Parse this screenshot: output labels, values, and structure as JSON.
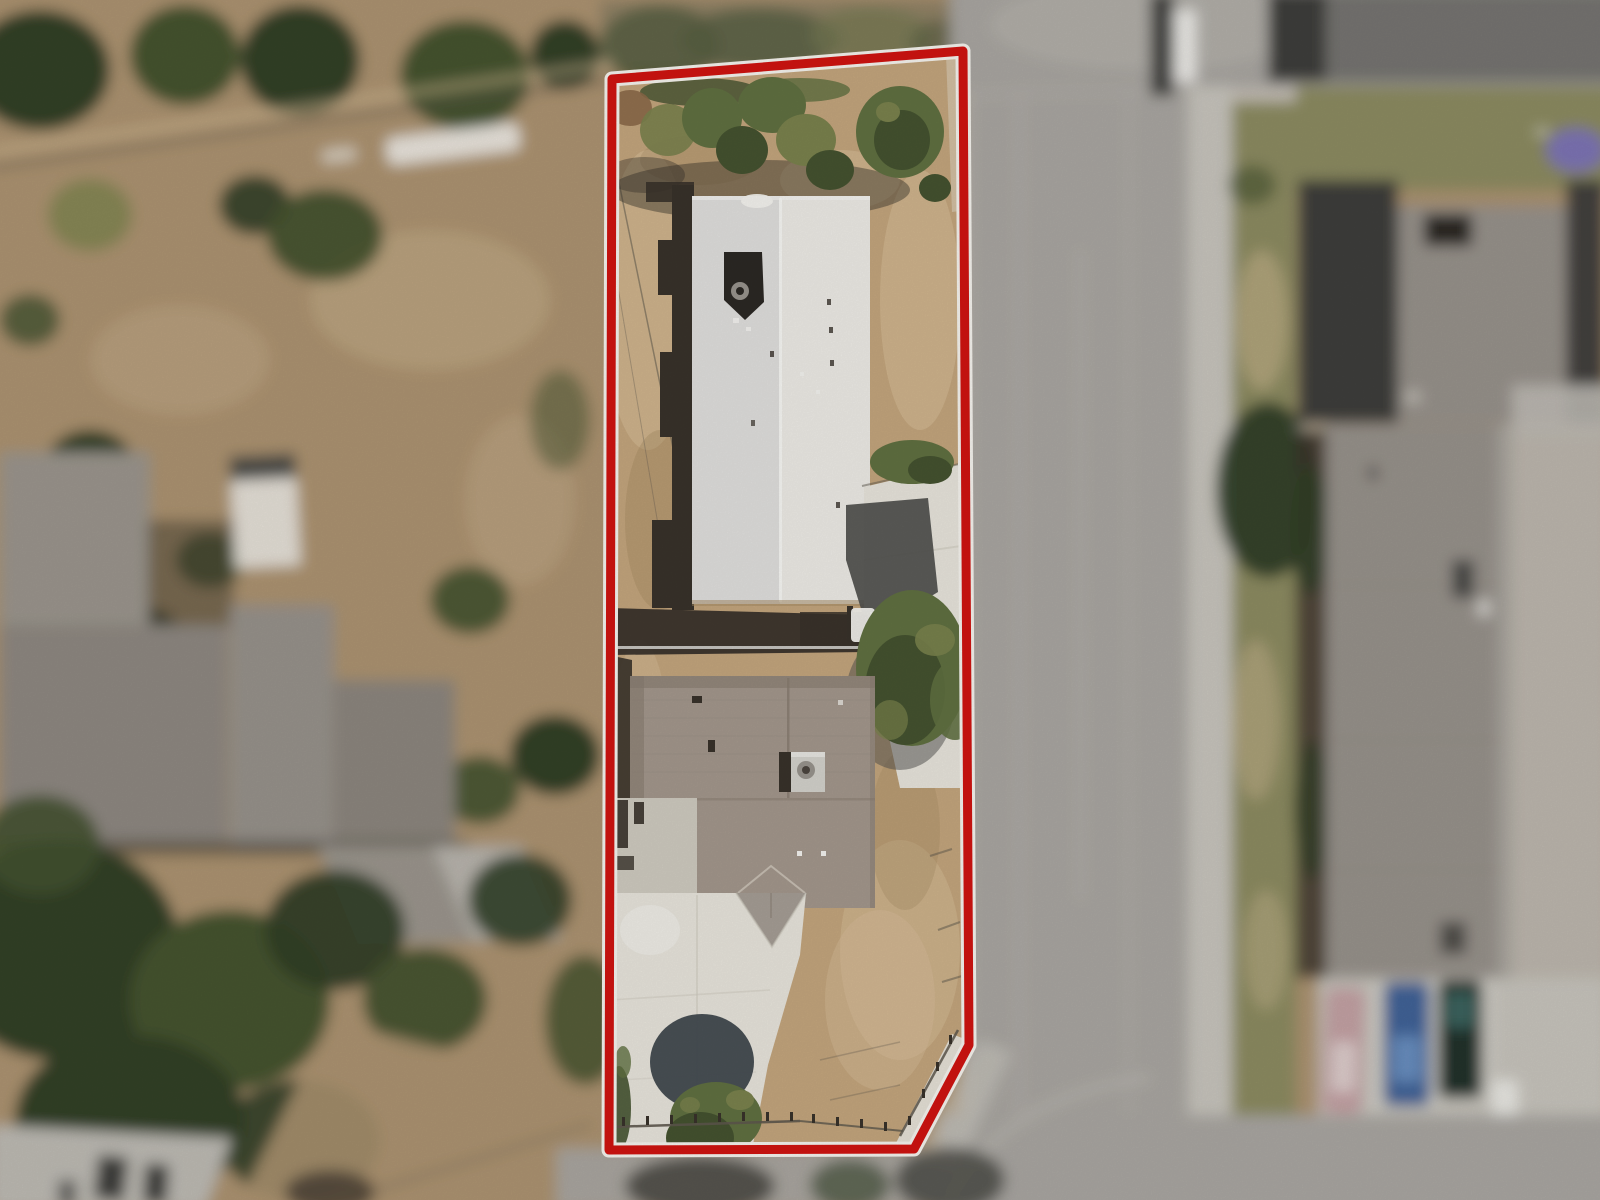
{
  "scene": {
    "type": "aerial-property-photo",
    "focus": "parcel highlighted by red boundary outline, surroundings blurred"
  },
  "colors": {
    "boundary_red": "#ce1410",
    "boundary_halo": "#f4f2ec",
    "dirt": "#c2a47c",
    "dirt_light": "#d7bf9a",
    "dirt_dark": "#a1875f",
    "dirt_blur": "#ab9270",
    "concrete": "#e6e3da",
    "concrete_dim": "#cdc9be",
    "roof_white": "#ebe9e4",
    "roof_white_dim": "#dedddb",
    "ridge_white": "#f6f6f3",
    "roof_taupe": "#a2968b",
    "roof_taupe_dark": "#877b6f",
    "gable_gray": "#a49c94",
    "ac_gray": "#d2d0ca",
    "vent_gray": "#97938c",
    "shadow": "#38322a",
    "shadow_deep": "#2b2824",
    "shadow_blue": "#4e4e4c",
    "shadow_blue2": "#3f474d",
    "tree_green": "#5f6f40",
    "tree_olive": "#79814c",
    "tree_dark": "#44522f",
    "tree_deep": "#313f28",
    "tree_murk": "#6d6d58",
    "bush_brown": "#8a6848",
    "grass": "#8b8a60",
    "road": "#a8a5a0",
    "road_light": "#bcb9b2",
    "sidewalk": "#c6c3bb",
    "fence": "#5d574c",
    "white": "#f2f1ed",
    "roof_blur1": "#9a948c",
    "roof_blur2": "#8d8780",
    "roof_blur3": "#96918a",
    "roof_blur4": "#8b857d",
    "bldg_dark": "#3d3d3a",
    "bldg_roof_top": "#757370",
    "car_pink": "#c2a0a3",
    "car_blue": "#3f6296",
    "car_dark": "#20302c",
    "car_teal": "#3f6b66",
    "car_blue_light": "#6f95c4",
    "purple": "#7a70bd",
    "blob_dark": "#45453e",
    "roof_highlight": "#cfc7bb"
  }
}
